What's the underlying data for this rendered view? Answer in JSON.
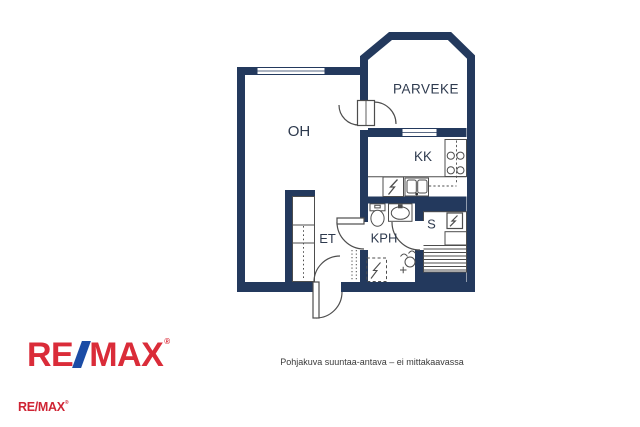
{
  "plan": {
    "rooms": {
      "oh": "OH",
      "parveke": "PARVEKE",
      "kk": "KK",
      "et": "ET",
      "kph": "KPH",
      "s": "S"
    },
    "colors": {
      "wall": "#23395d",
      "label": "#2e3a4e",
      "line": "#4d4d4d"
    },
    "icons": {
      "stove": "four-burner-cooktop",
      "kitchen_sink": "double-basin-sink",
      "kitchen_appliance": "electric-appliance-lightning",
      "toilet": "wc-toilet",
      "washbasin": "washbasin",
      "drain": "shower-floor-drain",
      "reservation": "appliance-reservation-dashed",
      "sauna_heater": "sauna-heater-lightning",
      "sauna_benches": "sauna-benches",
      "wardrobe": "wardrobe-closet",
      "coat_rack": "coat-rack-dotted"
    }
  },
  "footer": {
    "disclaimer": "Pohjakuva suuntaa-antava – ei mittakaavassa",
    "logo": {
      "re": "RE",
      "slash": "/",
      "max": "MAX",
      "registered": "®"
    },
    "logo_small": {
      "text": "RE/MAX",
      "registered": "®"
    },
    "colors": {
      "red": "#da2c39",
      "blue": "#1b4ca5"
    }
  }
}
